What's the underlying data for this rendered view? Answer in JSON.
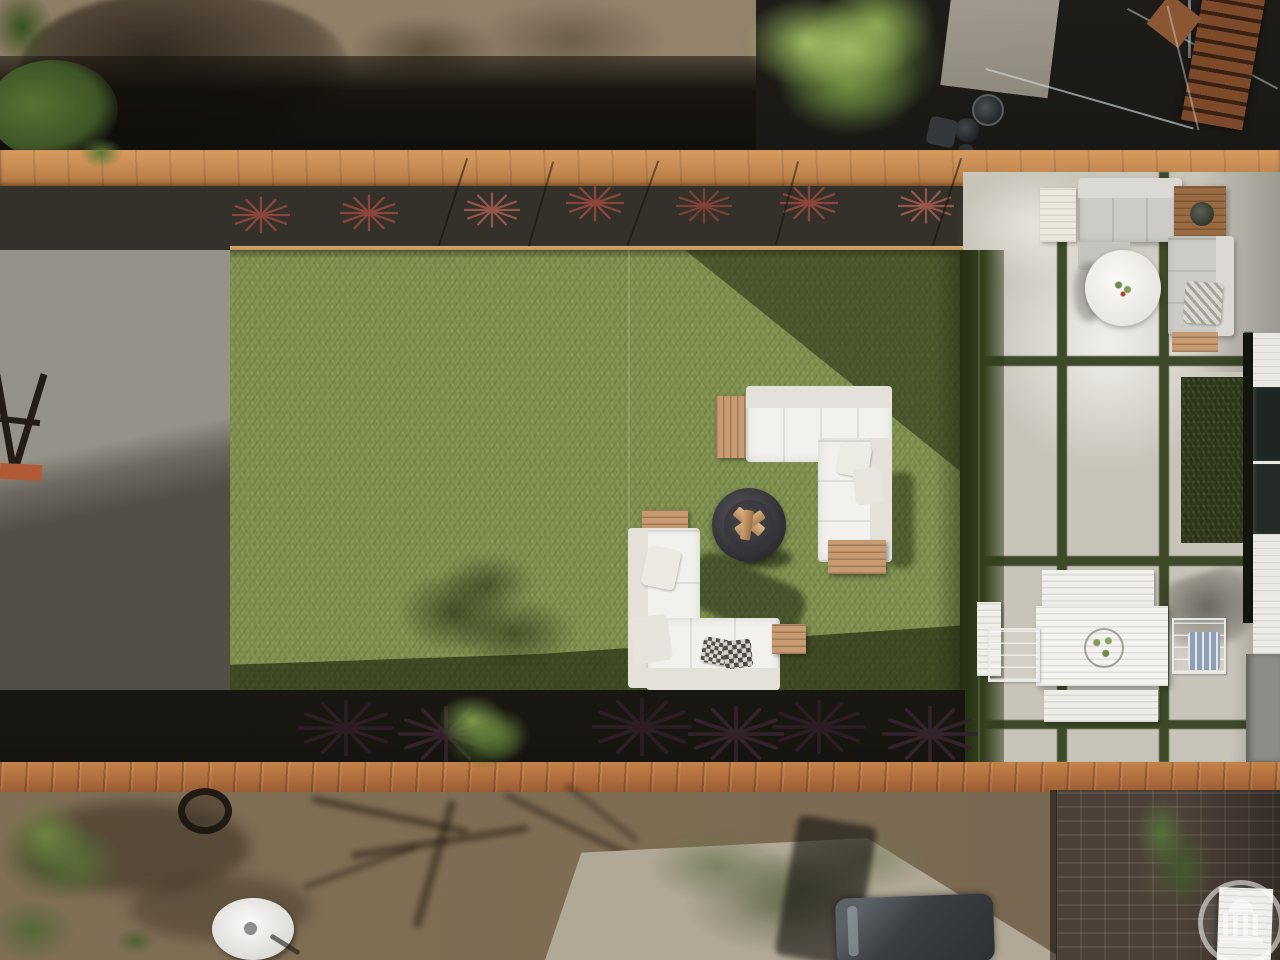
{
  "scene": {
    "title": "Aerial view of landscaped backyard",
    "description": "Top-down drone photo of a narrow backyard: artificial turf lawn with two white outdoor sectionals and a round fire pit, concrete paver patio with gray sectional, round white fire table and white slatted dining set, planter bed of red cordyline plants, wooden fences, neighboring dirt yards with shrubs, a parked car and brick paving",
    "watermark": {
      "letter": "S"
    },
    "palette": {
      "turf": "#7B8C4B",
      "turf-shadow": "#2F3C1C",
      "dirt-top": "#8B7B64",
      "mulch": "#34302A",
      "fence-wood": "#C98E55",
      "fence-bottom": "#AF6C3D",
      "concrete": "#C8C4BA",
      "concrete-bright": "#F2F0EA",
      "gravel-light": "#95928A",
      "gravel-dark": "#534E46",
      "shadow-band": "#161410",
      "dirt-bottom": "#7E6C53",
      "brick": "#4C4038",
      "sofa-white": "#F2F1ED",
      "sofa-gray": "#CDCBC5",
      "teak": "#C79A71",
      "teak-dark": "#9A6A42",
      "firepit": "#3A3A40",
      "plant-red": "#8A463C",
      "plant-dark": "#2B1D23",
      "tree-green": "#7FA04F",
      "tree-dark": "#4C662E",
      "bush-green": "#5E7039",
      "grid-strip": "#3D4928",
      "building-white": "#EAE8E2",
      "window-dark": "#1F2522",
      "wall-gray": "#8C8B87",
      "chair-blue": "#8FA0B4",
      "orange-accent": "#B05B36"
    },
    "objects": [
      "artificial-turf-lawn",
      "white-sectional-sofa-upper",
      "white-sectional-sofa-lower",
      "fire-pit-bowl-with-logs",
      "teak-side-tables",
      "concrete-paver-patio",
      "gray-sectional-sofa",
      "round-white-fire-table",
      "teak-coffee-table",
      "white-dining-table",
      "dining-benches",
      "wire-chairs",
      "potted-plant-centerpiece",
      "red-cordyline-planter-bed",
      "top-wood-fence",
      "bottom-wood-fence",
      "green-tree",
      "neighbor-dirt-yard",
      "white-satellite-dish",
      "parked-car",
      "brick-paving",
      "house-siding-with-windows",
      "wood-staircase",
      "watermark-logo"
    ]
  }
}
